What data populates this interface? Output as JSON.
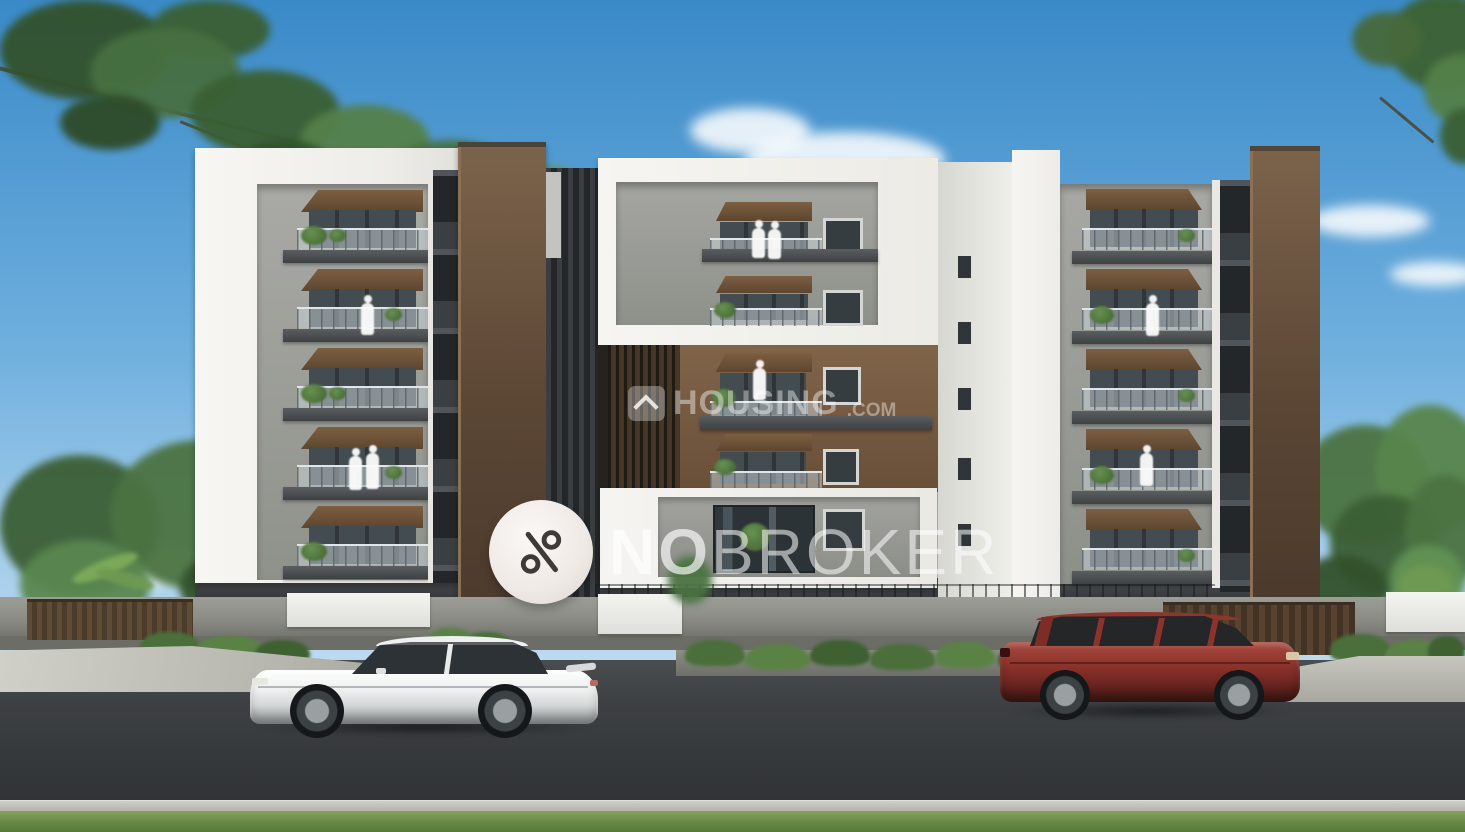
{
  "watermarks": {
    "nobroker": {
      "icon": "percent-icon",
      "text_primary": "NO",
      "text_secondary": "BROKER"
    },
    "housing": {
      "icon": "house-chevron-icon",
      "text": "HOUSING",
      "suffix": ".COM"
    }
  },
  "colors": {
    "sky-top": "#3a8ac8",
    "sky-horizon": "#c6dff1",
    "facade-white": "#f0efeb",
    "facade-gray": "#95978f",
    "facade-brown": "#6b523b",
    "canopy-brown": "#6e5138",
    "wall-gray": "#8a8c85",
    "road": "#3e4144",
    "grass": "#6a8a47",
    "car-white": "#eef0f0",
    "car-red": "#93382f",
    "gate-brown": "#57432f",
    "foliage-green": "#4b7342"
  }
}
